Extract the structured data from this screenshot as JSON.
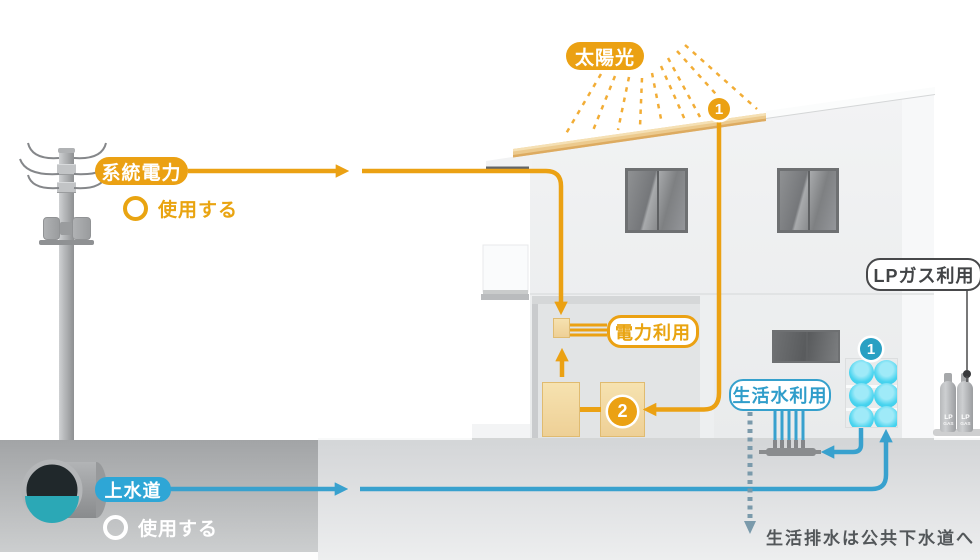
{
  "labels": {
    "solar": "太陽光",
    "grid": "系統電力",
    "use_grid": "使用する",
    "power_use": "電力利用",
    "lp_gas": "LPガス利用",
    "water_use": "生活水利用",
    "water_main": "上水道",
    "use_water": "使用する",
    "sewer_note": "生活排水は公共下水道へ",
    "cylinder_top": "LP",
    "cylinder_bottom": "GAS"
  },
  "badges": {
    "roof": "1",
    "conditioner": "2",
    "tank": "1"
  },
  "colors": {
    "orange": "#eba113",
    "blue": "#38a1ce",
    "cyan": "#40d0ec",
    "badge_blue": "#29a0c3",
    "panel_tan": "#ecca8e",
    "equipment_tan": "#f3dca6",
    "steel_arrow": "#7a9aab",
    "note_text": "#53575a"
  }
}
